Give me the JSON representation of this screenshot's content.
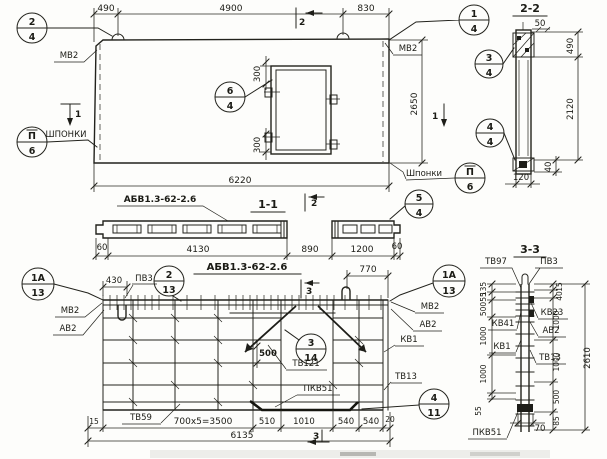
{
  "meta": {
    "product_code": "АБВ1.3-62-2.6"
  },
  "plan": {
    "dim_490": "490",
    "dim_4900": "4900",
    "dim_830": "830",
    "dim_300_top": "300",
    "dim_300_bot": "300",
    "dim_2650": "2650",
    "dim_6220": "6220",
    "mv2_left": "МВ2",
    "mv2_right": "МВ2",
    "shponki_left": "ШПОНКИ",
    "shponki_right": "Шпонки",
    "mark1_left": "1",
    "mark1_right": "1",
    "mark2_top": "2",
    "mark2_bottom": "2",
    "c24_t": "2",
    "c24_b": "4",
    "c14_t": "1",
    "c14_b": "4",
    "c64_t": "6",
    "c64_b": "4",
    "cp6l_t": "П",
    "cp6l_b": "6",
    "cp6r_t": "П",
    "cp6r_b": "6"
  },
  "s22": {
    "title": "2-2",
    "dim_50": "50",
    "dim_490": "490",
    "dim_2120": "2120",
    "dim_40": "40",
    "dim_120": "120",
    "c34_t": "3",
    "c34_b": "4",
    "c44_t": "4",
    "c44_b": "4"
  },
  "s11": {
    "title": "1-1",
    "product": "АБВ1.3-62-2.6",
    "c54_t": "5",
    "c54_b": "4",
    "dim_60l": "60",
    "dim_4130": "4130",
    "dim_890": "890",
    "dim_1200": "1200",
    "dim_60r": "60"
  },
  "elev": {
    "title": "АБВ1.3-62-2.6",
    "dim_430": "430",
    "dim_770": "770",
    "dim_500": "500",
    "dim_15": "15",
    "dim_3500": "700х5=3500",
    "dim_510": "510",
    "dim_1010": "1010",
    "dim_540a": "540",
    "dim_540b": "540",
    "dim_20": "20",
    "dim_6135": "6135",
    "pv3": "ПВ3",
    "mv2_l": "МВ2",
    "av2_l": "АВ2",
    "mv2_r": "МВ2",
    "av2_r": "АВ2",
    "tv121": "ТВ121",
    "kv1": "КВ1",
    "tv13": "ТВ13",
    "pkv51": "ПКВ51",
    "tv59": "ТВ59",
    "mark3_top": "3",
    "mark3_bot": "3",
    "c1al_t": "1А",
    "c1al_b": "13",
    "c213_t": "2",
    "c213_b": "13",
    "c1ar_t": "1А",
    "c1ar_b": "13",
    "c314_t": "3",
    "c314_b": "14",
    "c411_t": "4",
    "c411_b": "11"
  },
  "s33": {
    "title": "3-3",
    "tv97": "ТВ97",
    "pv3": "ПВ3",
    "kv41": "КВ41",
    "kv1": "КВ1",
    "kv23": "КВ23",
    "av2": "АВ2",
    "tv13": "ТВ13",
    "pkv51": "ПКВ51",
    "dl_135": "135",
    "dl_55t": "55",
    "dl_500": "500",
    "dl_1000a": "1000",
    "dl_1000b": "1000",
    "dl_55b": "55",
    "dr_15": "15",
    "dr_40": "40",
    "dr_1000a": "1000",
    "dr_1000b": "1000",
    "dr_500": "500",
    "dr_85": "85",
    "dim_2610": "2610",
    "dim_70": "70"
  }
}
